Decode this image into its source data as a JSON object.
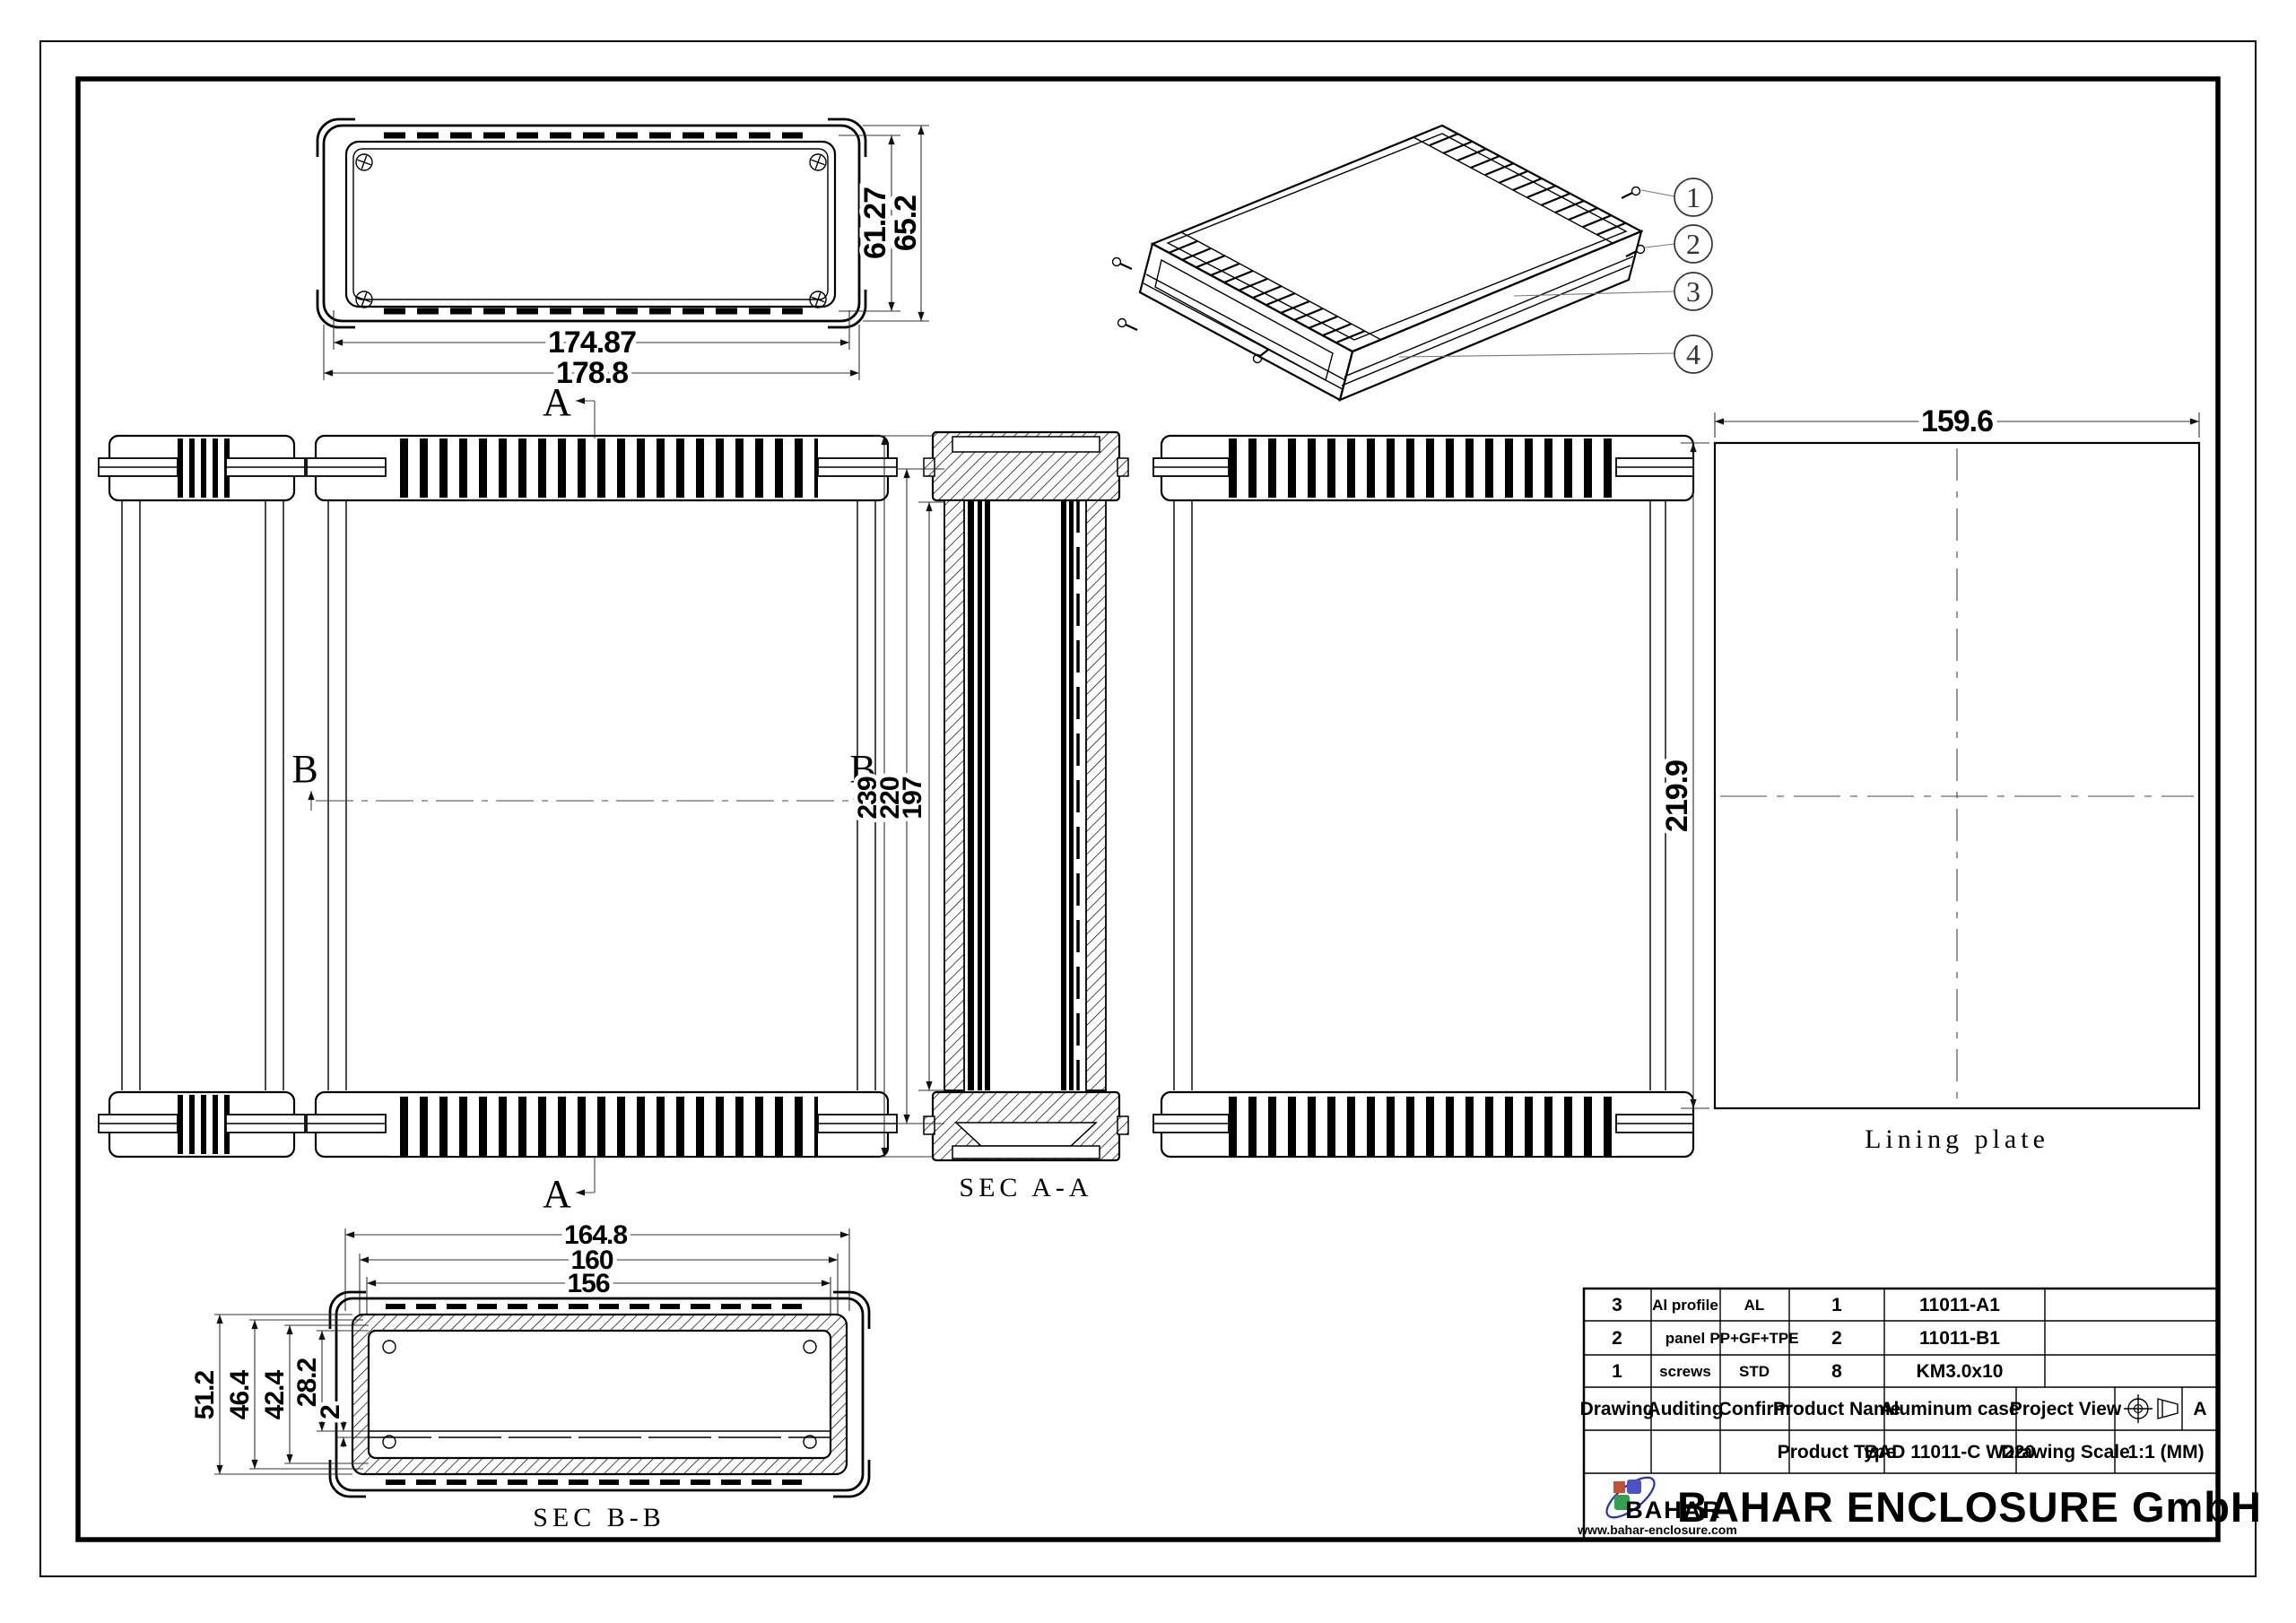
{
  "drawing": {
    "top_view": {
      "dim_inner_width": "174.87",
      "dim_outer_width": "178.8",
      "dim_inner_height": "61.27",
      "dim_outer_height": "65.2"
    },
    "section_a": "A",
    "section_b": "B",
    "sec_aa": {
      "label": "SEC A-A",
      "dim_overall": "239",
      "dim_mid": "220",
      "dim_inner": "197"
    },
    "sec_bb": {
      "label": "SEC B-B",
      "dim_w1": "164.8",
      "dim_w2": "160",
      "dim_w3": "156",
      "dim_h1": "51.2",
      "dim_h2": "46.4",
      "dim_h3": "42.4",
      "dim_h4": "28.2",
      "dim_h5": "2"
    },
    "lining_plate": {
      "label": "Lining plate",
      "dim_width": "159.6",
      "dim_height": "219.9"
    },
    "callouts": {
      "c1": "1",
      "c2": "2",
      "c3": "3",
      "c4": "4"
    }
  },
  "title_block": {
    "parts": [
      {
        "no": "3",
        "name": "Al profile",
        "material": "AL",
        "qty": "1",
        "part_no": "11011-A1"
      },
      {
        "no": "2",
        "name": "panel",
        "material": "PP+GF+TPE",
        "qty": "2",
        "part_no": "11011-B1"
      },
      {
        "no": "1",
        "name": "screws",
        "material": "STD",
        "qty": "8",
        "part_no": "KM3.0x10"
      }
    ],
    "drawing_label": "Drawing",
    "auditing_label": "Auditing",
    "confirm_label": "Confirm",
    "product_name_label": "Product Name",
    "product_name": "Aluminum case",
    "project_view_label": "Project View",
    "revision": "A",
    "product_type_label": "Product Type",
    "product_type": "BAD 11011-C W220",
    "drawing_scale_label": "Drawing Scale",
    "drawing_scale": "1:1 (MM)",
    "company": {
      "name": "BAHAR ENCLOSURE GmbH",
      "logo": "BAHAR",
      "website": "www.bahar-enclosure.com"
    }
  },
  "colors": {
    "line": "#000000",
    "dimension": "#333333",
    "logo_orange": "#c0522f",
    "logo_blue": "#4a52c4",
    "logo_green": "#2fa14f",
    "logo_swoosh": "#2233bb"
  }
}
